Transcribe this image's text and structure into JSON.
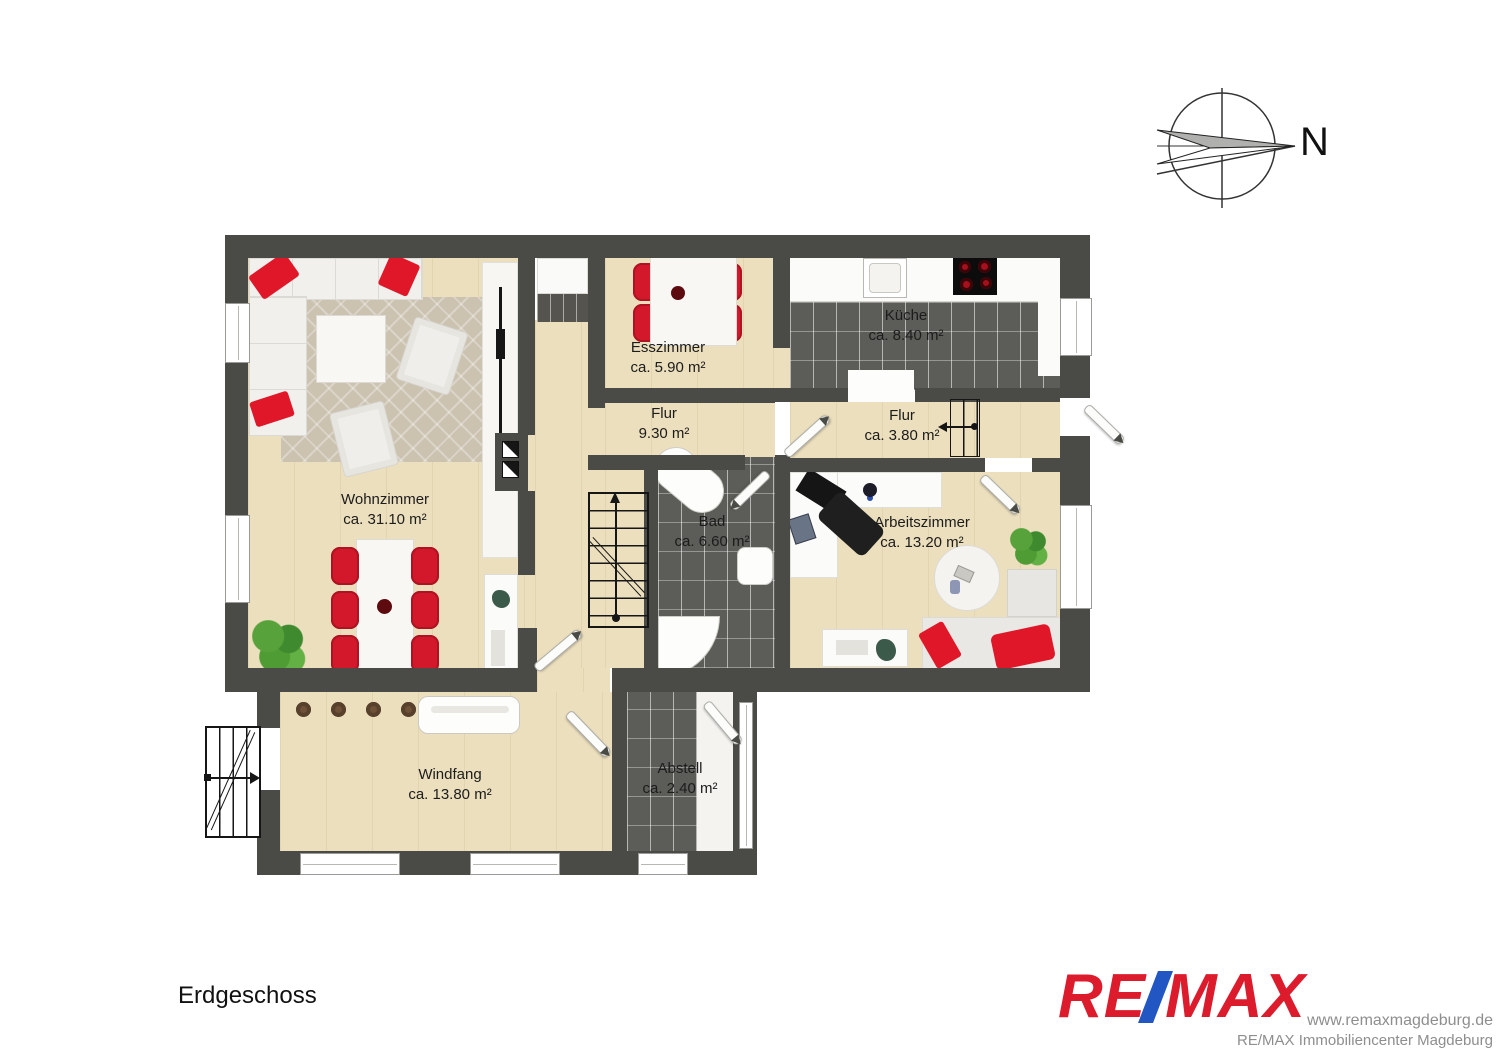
{
  "meta": {
    "floor_label": "Erdgeschoss",
    "compass_label": "N"
  },
  "rooms": [
    {
      "name": "Wohnzimmer",
      "area": "ca. 31.10 m²"
    },
    {
      "name": "Esszimmer",
      "area": "ca. 5.90 m²"
    },
    {
      "name": "Küche",
      "area": "ca. 8.40 m²"
    },
    {
      "name": "Flur",
      "area": "9.30 m²"
    },
    {
      "name": "Flur",
      "area": "ca. 3.80 m²"
    },
    {
      "name": "Bad",
      "area": "ca. 6.60 m²"
    },
    {
      "name": "Arbeitszimmer",
      "area": "ca. 13.20 m²"
    },
    {
      "name": "Windfang",
      "area": "ca. 13.80 m²"
    },
    {
      "name": "Abstell",
      "area": "ca. 2.40 m²"
    }
  ],
  "branding": {
    "logo_re": "RE",
    "logo_max": "MAX",
    "website": "www.remaxmagdeburg.de",
    "office_name": "RE/MAX Immobiliencenter Magdeburg",
    "logo_red": "#dc1c2c",
    "logo_blue": "#2156c3"
  },
  "colors": {
    "wall": "#4a4a46",
    "wood_floor": "#ecdfbd",
    "tile_floor": "#5c5c58",
    "furniture_red": "#d2182a"
  }
}
